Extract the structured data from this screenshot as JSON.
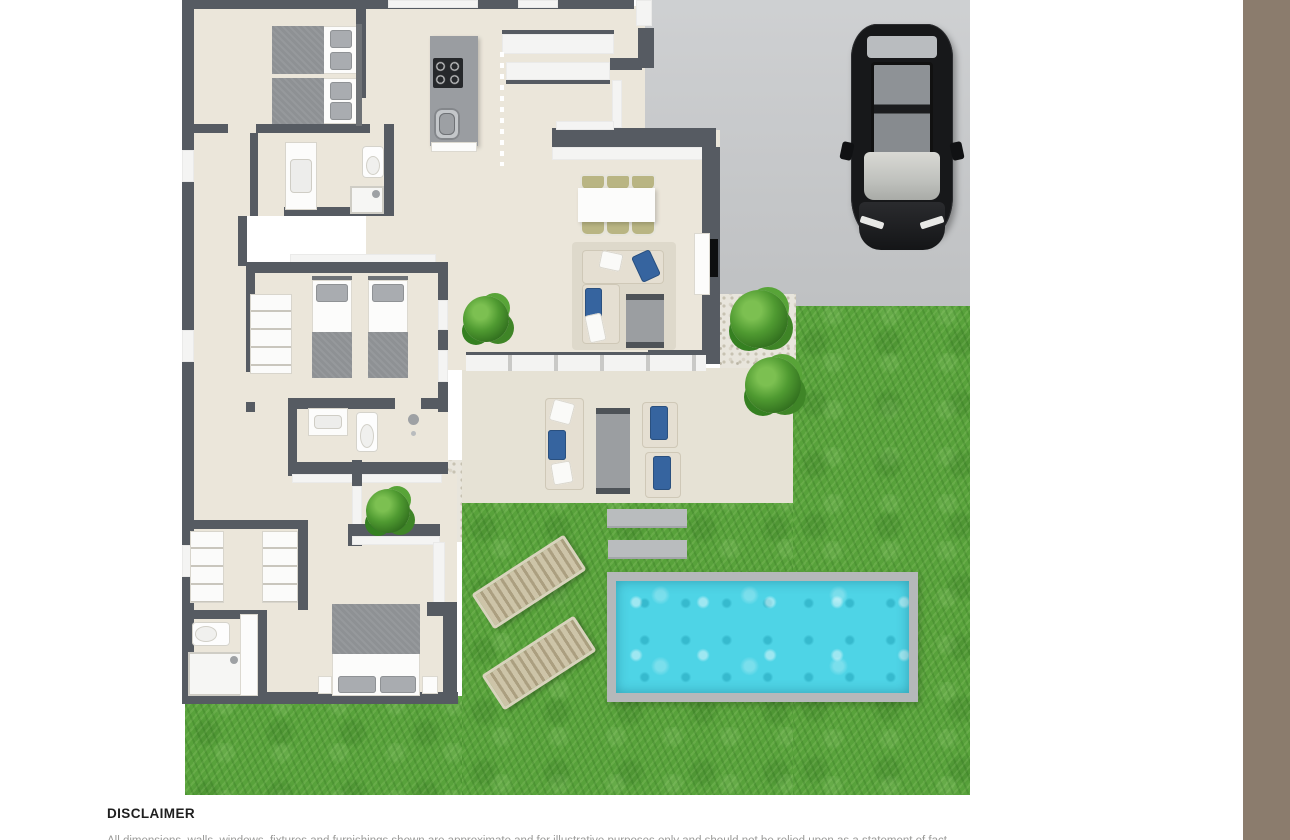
{
  "disclaimer": {
    "title": "DISCLAIMER",
    "body_clipped": "All dimensions, walls, windows, fixtures and furnishings shown are approximate and for illustrative purposes only and should not be relied upon as a statement of fact."
  },
  "colors": {
    "wall": "#565b62",
    "wallface": "#f4f4f3",
    "floor": "#ebe6da",
    "patio": "#e6e2d5",
    "drive": "#c9cbcd",
    "grass": "#58a23b",
    "gravel": "#e8e5dc",
    "water": "#4ed4e6",
    "poolb": "#b5b8ba",
    "band": "#8b7c6d",
    "accent_blue": "#36649f",
    "sofa_cream": "#e5dfd2",
    "car_black": "#17181a"
  },
  "scene": {
    "type": "3d-top-down-floor-plan",
    "rooms": [
      {
        "name": "bedroom-1",
        "furniture": [
          "twin-bed",
          "twin-bed"
        ]
      },
      {
        "name": "bathroom-1",
        "furniture": [
          "vanity-sink",
          "toilet",
          "shower"
        ]
      },
      {
        "name": "kitchen",
        "furniture": [
          "island-counter",
          "cooktop",
          "kitchen-sink"
        ]
      },
      {
        "name": "dining-area",
        "furniture": [
          "dining-table",
          "six-chairs"
        ]
      },
      {
        "name": "living-room",
        "furniture": [
          "corner-sofa",
          "coffee-table",
          "tv-cabinet",
          "tv"
        ]
      },
      {
        "name": "bedroom-2",
        "furniture": [
          "twin-bed",
          "twin-bed",
          "wardrobe"
        ]
      },
      {
        "name": "bathroom-2",
        "furniture": [
          "sink",
          "toilet",
          "shower-head"
        ]
      },
      {
        "name": "walk-in-closet",
        "furniture": [
          "shelving-unit",
          "shelving-unit"
        ]
      },
      {
        "name": "master-bedroom",
        "furniture": [
          "double-bed",
          "nightstand",
          "nightstand"
        ]
      },
      {
        "name": "bathroom-3",
        "furniture": [
          "toilet",
          "shower",
          "vanity-counter"
        ]
      }
    ],
    "outdoor": [
      "driveway",
      "black-car",
      "lawn",
      "terrace-patio",
      "outdoor-sofa",
      "outdoor-coffee-table",
      "outdoor-armchair",
      "outdoor-armchair",
      "stepping-stones",
      "swimming-pool",
      "sun-lounger",
      "sun-lounger",
      "garden-bush",
      "garden-bush",
      "garden-bush",
      "garden-bush",
      "gravel-courtyards"
    ]
  },
  "layout_note": {
    "right_margin_band": true
  }
}
